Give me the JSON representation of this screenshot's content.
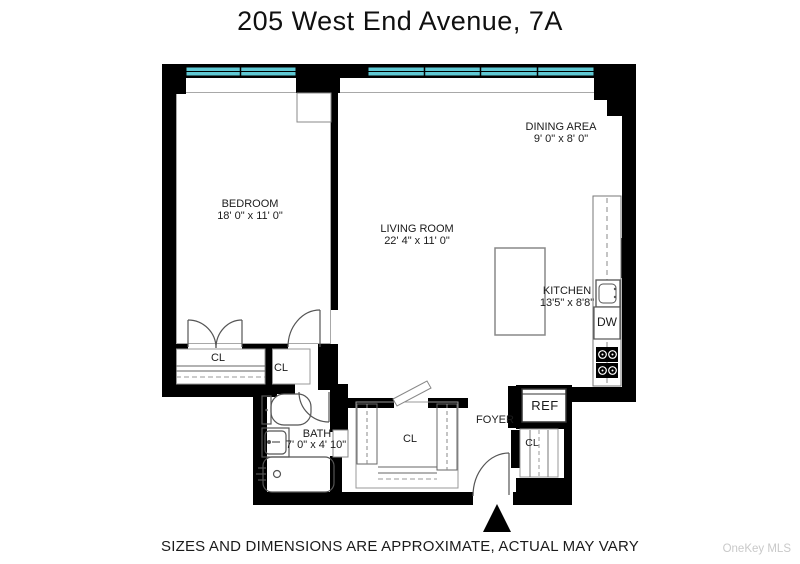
{
  "title": "205 West End Avenue, 7A",
  "disclaimer": "SIZES AND DIMENSIONS ARE APPROXIMATE, ACTUAL MAY VARY",
  "watermark": "OneKey MLS",
  "colors": {
    "window": "#5fc8d3",
    "wall": "#000000"
  },
  "rooms": {
    "bedroom": {
      "name": "BEDROOM",
      "dims": "18' 0\" x 11' 0\""
    },
    "living_room": {
      "name": "LIVING ROOM",
      "dims": "22' 4\" x 11' 0\""
    },
    "dining_area": {
      "name": "DINING AREA",
      "dims": "9' 0\" x 8' 0\""
    },
    "kitchen": {
      "name": "KITCHEN",
      "dims": "13'5\" x 8'8\""
    },
    "bath": {
      "name": "BATH",
      "dims": "7' 0\" x 4' 10\""
    },
    "foyer": {
      "name": "FOYER"
    }
  },
  "fixtures": {
    "closet": "CL",
    "dishwasher": "DW",
    "refrigerator": "REF"
  }
}
